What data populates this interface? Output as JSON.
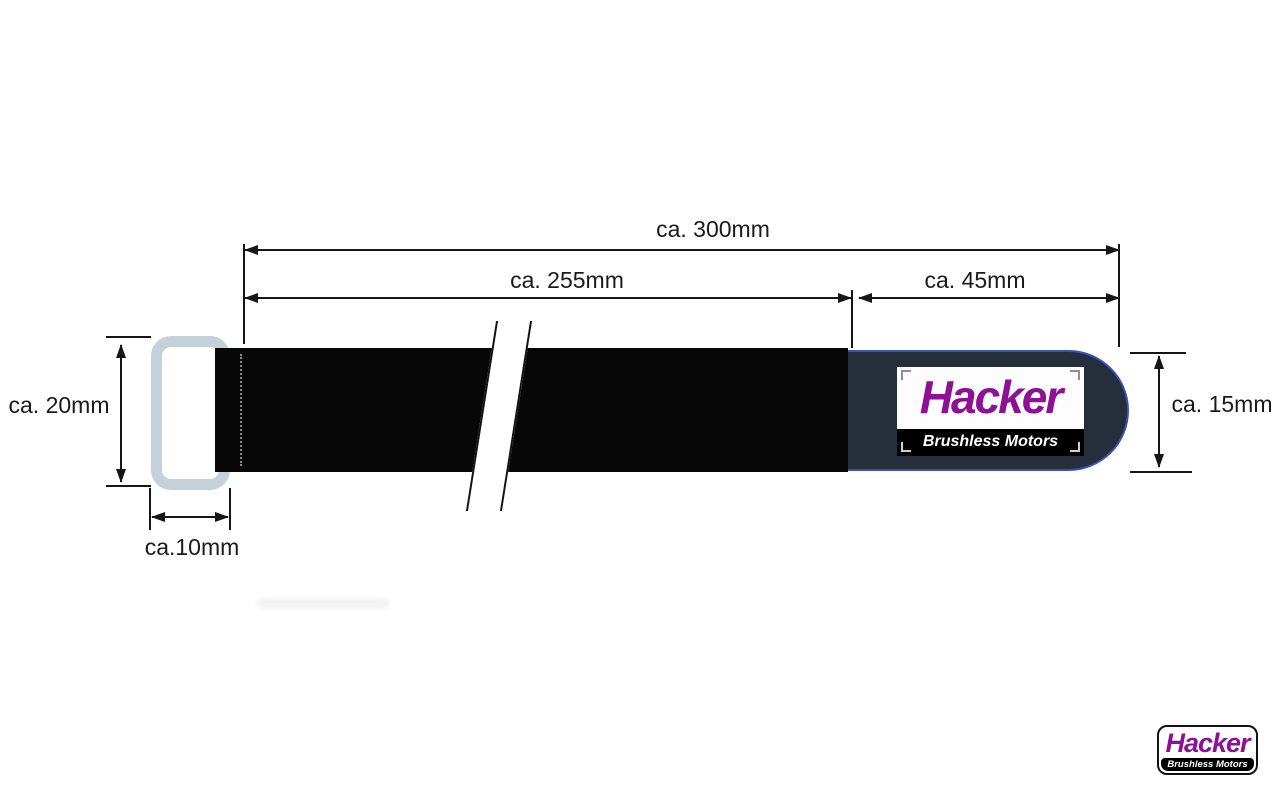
{
  "diagram": {
    "title_hint": "velcro-strap-dimension-drawing",
    "dim_total": "ca. 300mm",
    "dim_strap": "ca. 255mm",
    "dim_tab": "ca. 45mm",
    "dim_buckle_height": "ca. 20mm",
    "dim_tab_height": "ca. 15mm",
    "dim_buckle_width": "ca.10mm",
    "strap_label": {
      "brand": "Hacker",
      "subtitle": "Brushless Motors"
    },
    "colors": {
      "strap_black": "#070707",
      "tab_navy": "#262e3c",
      "tab_edge_blue": "#3552c2",
      "buckle_gray": "#c5d1d8",
      "brand_purple": "#8d1095",
      "dimension_line": "#161616",
      "background": "#ffffff"
    }
  },
  "watermark_logo": {
    "brand": "Hacker",
    "subtitle": "Brushless Motors"
  }
}
